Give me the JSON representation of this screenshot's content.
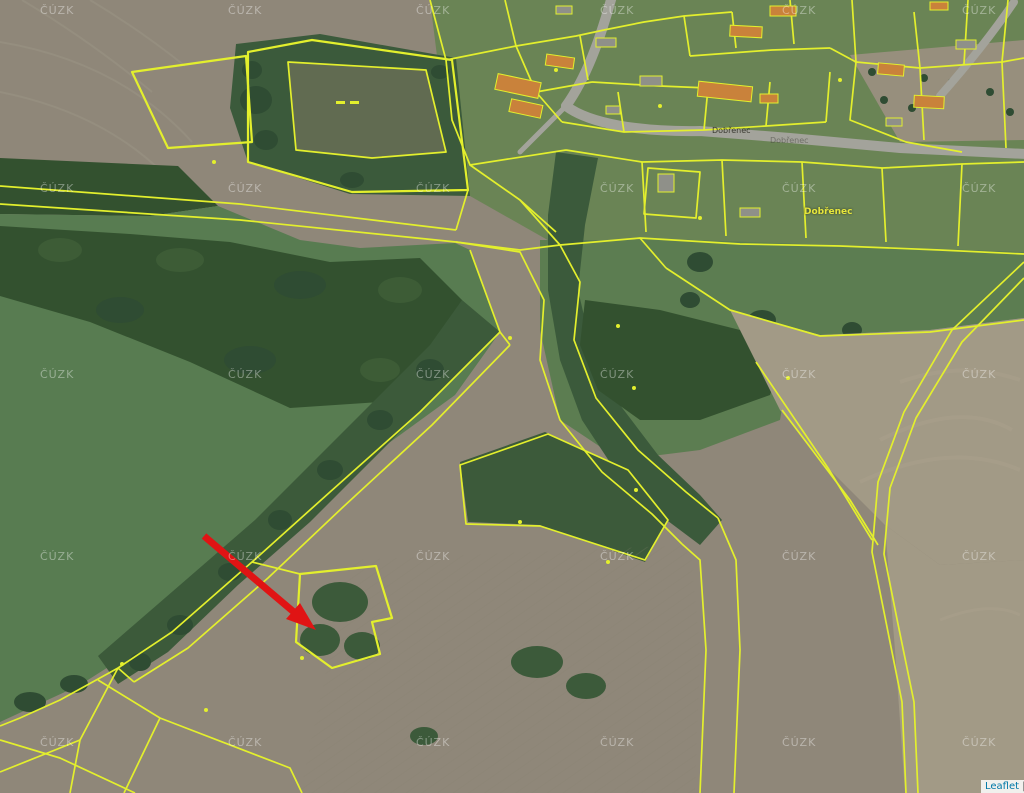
{
  "map": {
    "type": "cadastral-aerial-map",
    "attribution": {
      "library": "Leaflet",
      "separator": " |"
    },
    "watermarks": {
      "text": "ČÚZK",
      "columns": [
        40,
        228,
        416,
        600,
        782,
        962
      ],
      "rows": [
        4,
        182,
        368,
        550,
        736
      ]
    },
    "labels": {
      "items": [
        {
          "text": "Dobřenec"
        },
        {
          "text": "Dobřenec"
        },
        {
          "text": "Dobřenec"
        }
      ]
    },
    "arrow": {
      "meaning": "highlighted-parcel-pointer"
    }
  },
  "colors": {
    "parcel_line": "#e3ef2d",
    "field_tan": "#8f8779",
    "meadow_green": "#587c51",
    "forest_green": "#33512f",
    "pond_olive": "#616b51",
    "road_gray": "#a3a39b",
    "building_orange": "#c9823b",
    "arrow_red": "#e01414",
    "attribution_link": "#0078A8"
  }
}
